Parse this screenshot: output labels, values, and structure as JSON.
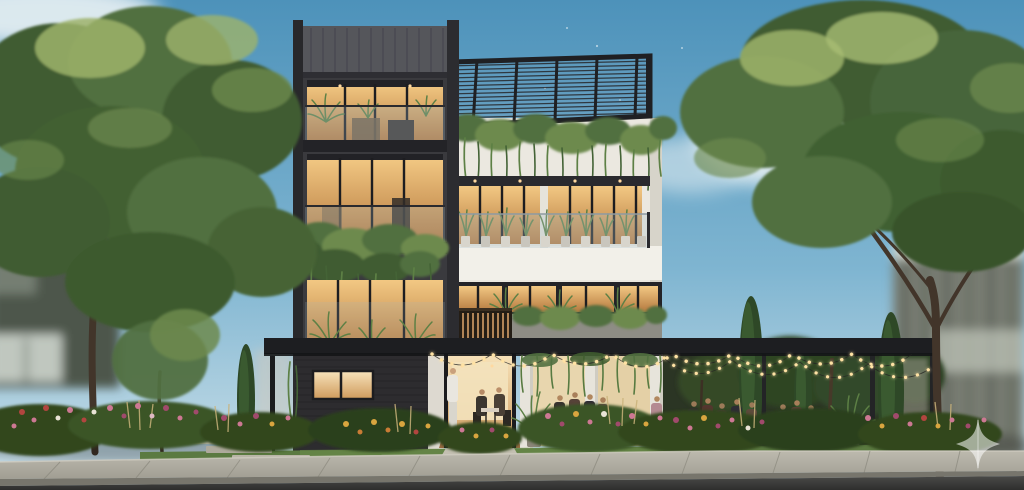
{
  "scene": {
    "type": "architectural-exterior-render",
    "description": "Daytime photorealistic render of a modern four-storey building: dark speckled stone tower on the left, white terrace volume on the right with a black rooftop pergola and cascading plants, glass balustrade balconies with warm-lit interiors and potted greenery, and a ground-floor cafe terrace with string lights where people dine, framed by large trees, cypresses, flower beds, a paver path, concrete sidewalk and asphalt street under a blue sky",
    "labels": {
      "sky": "blue sky with soft clouds and sparkle particles",
      "background_left_house": "blurred neighbouring house behind left tree",
      "background_right_building": "blurred glass building behind right tree",
      "left_tree": "large deciduous tree on the left",
      "right_tree": "large deciduous tree on the right",
      "building": "modern cafe building facade",
      "dark_tower": "dark stone tower with warm-lit balconies",
      "metal_parapet": "standing-seam metal top band",
      "roof_pergola": "black slatted rooftop pergola",
      "hanging_plants": "plants cascading from roof edge",
      "balcony_3f": "third-floor glass balcony with potted plants",
      "balcony_2f": "second-floor windows with concrete planter and vines",
      "wood_railing": "warm wood slat railing",
      "ground_cafe": "open ground-floor cafe terrace",
      "entrance": "warm-lit entrance doorway",
      "string_lights": "festoon string lights over the terrace",
      "indoor_diners": "two guests dining inside",
      "outdoor_diners": "guests dining on the garden terrace",
      "waiter": "waiter in white standing at the door",
      "cypresses": "slim cypress trees",
      "flower_beds": "mixed pink, red and yellow flower beds",
      "lawn": "green lawn strip",
      "paver_path": "light stepping-stone path",
      "sidewalk": "concrete sidewalk with joints",
      "road": "asphalt street",
      "watermark": "translucent four-point star logo watermark"
    }
  },
  "colors": {
    "sky_top": "#4d92ba",
    "sky_mid": "#7fb5d1",
    "sky_horizon": "#cfe2ea",
    "cloud": "#f4f8f8",
    "canopy_dark": "#3f5c30",
    "canopy_mid": "#517040",
    "canopy_light": "#6d8a4e",
    "canopy_highlight": "#9db36b",
    "trunk_brown": "#42352a",
    "tower_dark": "#3a3a3e",
    "tower_metal": "#55565b",
    "facade_white": "#ebe8e0",
    "facade_shadow": "#d7d4ca",
    "window_warm_light": "#f2c883",
    "window_warm_deep": "#b5793f",
    "frame_dark": "#1d1d20",
    "pergola_black": "#1d1e21",
    "glass_tint": "#a9c0cb",
    "wood_slat": "#b08457",
    "concrete_planter": "#8e8d85",
    "vine_green": "#577a41",
    "string_bulb": "#ffe2a4",
    "flower_pink": "#cd7893",
    "flower_magenta": "#a14a6c",
    "flower_red": "#b2453f",
    "flower_yellow": "#d9a53f",
    "flower_orange": "#c97c35",
    "flower_white": "#e9e3d6",
    "foliage_dark": "#31471f",
    "lawn_green": "#5b7a41",
    "paver_light": "#b9b5a7",
    "sidewalk_top": "#b3b0a4",
    "curb_face": "#77756c",
    "road_asphalt": "#3a3a39",
    "background_house": "#4e574c",
    "background_window": "#cdd4cc",
    "watermark_white": "#ffffff"
  },
  "watermark": {
    "shape": "four-point-star",
    "color": "#ffffff",
    "opacity": 0.55
  }
}
